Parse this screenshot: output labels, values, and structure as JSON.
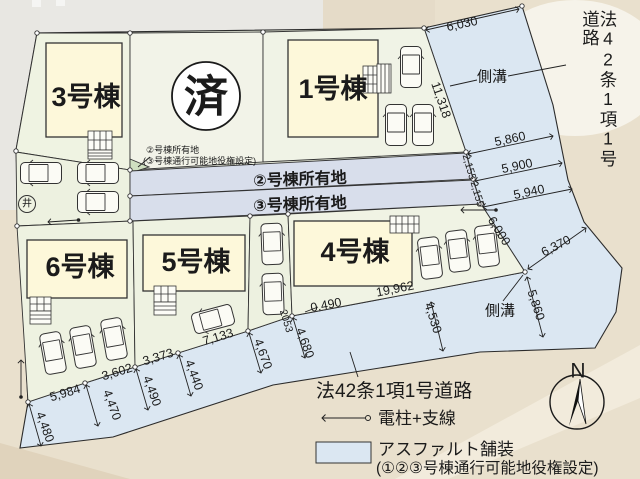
{
  "plan": {
    "buildings": {
      "b3": "3号棟",
      "b1": "1号棟",
      "b6": "6号棟",
      "b5": "5号棟",
      "b4": "4号棟"
    },
    "sold_mark": "済",
    "strip2_label": "②号棟所有地",
    "strip3_label": "③号棟所有地",
    "annotation": {
      "line1": "②号棟所有地",
      "line2": "(③号棟通行可能地役権設定)"
    },
    "well_mark": "井"
  },
  "roads": {
    "right_road_label": "法42条1項1号道路",
    "bottom_road_label": "法42条1項1号道路",
    "gutter_top": "側溝",
    "gutter_bottom": "側溝"
  },
  "dimensions": {
    "d6030": "6,030",
    "d11318": "11,318",
    "d5860a": "5,860",
    "d5900": "5,900",
    "d5940": "5,940",
    "d2155a": "2,155",
    "d2155b": "2,155",
    "d6000": "6,000",
    "d6370": "6,370",
    "d5860b": "5,860",
    "d4530": "4,530",
    "d19962": "19,962",
    "d0490": "0.490",
    "d2053": "2053",
    "d7133": "7,133",
    "d3373": "3,373",
    "d3602": "3,602",
    "d5984": "5,984",
    "d4480": "4,480",
    "d4470": "4,470",
    "d4490": "4,490",
    "d4440": "4,440",
    "d4670": "4,670",
    "d4680": "4,680"
  },
  "legend": {
    "pole_label": "電柱+支線",
    "asphalt_line1": "アスファルト舗装",
    "asphalt_line2": "(①②③号棟通行可能地役権設定)"
  },
  "compass": {
    "north": "N"
  },
  "colors": {
    "lot_fill": "#eef2e1",
    "sold_lot_fill": "#f2f3e8",
    "building_fill": "#fdf8da",
    "strip_fill": "#d8deeb",
    "road_fill": "#dbe7f2",
    "photo_beige": "#e9e0cd"
  }
}
